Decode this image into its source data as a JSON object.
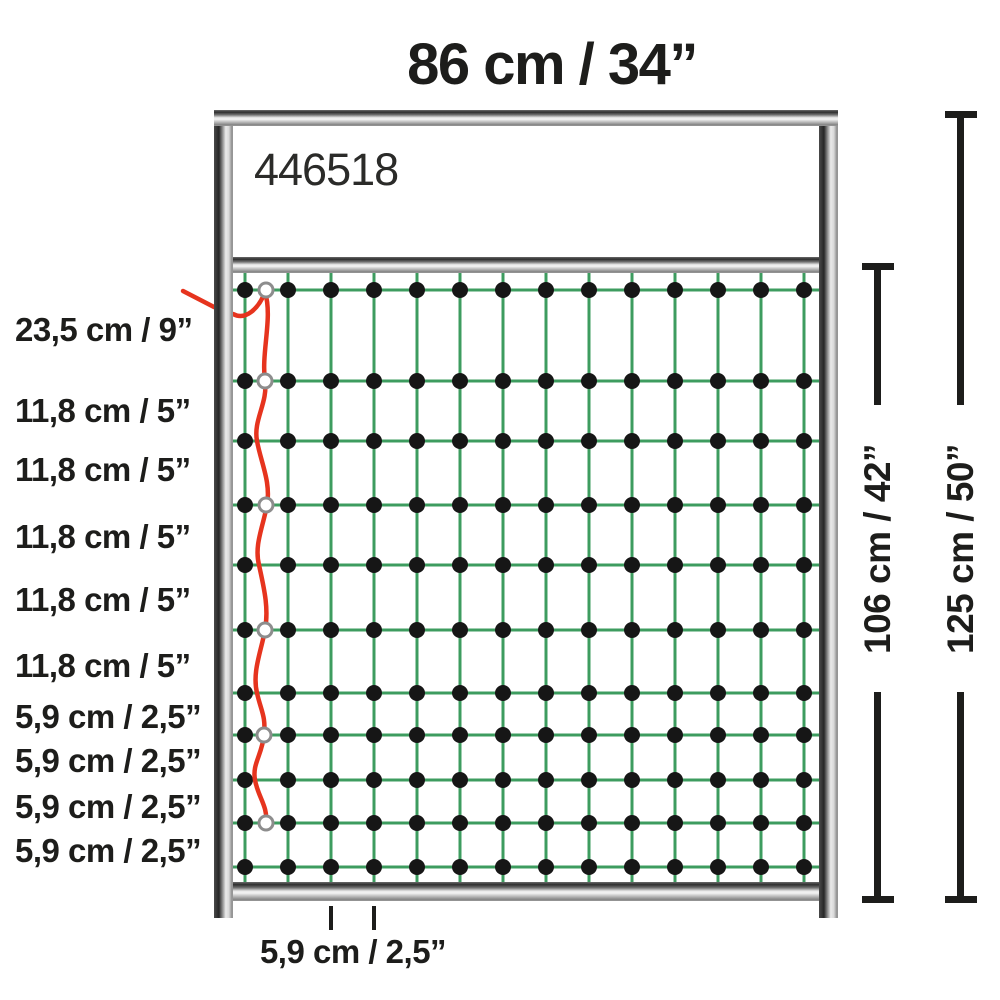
{
  "title": "86 cm / 34”",
  "product_number": "446518",
  "left_labels": [
    "23,5 cm / 9”",
    "11,8 cm / 5”",
    "11,8 cm / 5”",
    "11,8 cm / 5”",
    "11,8 cm / 5”",
    "11,8 cm / 5”",
    "5,9 cm / 2,5”",
    "5,9 cm / 2,5”",
    "5,9 cm / 2,5”",
    "5,9 cm / 2,5”"
  ],
  "right_dimensions": {
    "net_height": "106 cm / 42”",
    "total_height": "125 cm / 50”"
  },
  "bottom_label": "5,9 cm / 2,5”",
  "colors": {
    "net_green": "#3d9c5f",
    "conductor_red": "#e6341e",
    "knot_black": "#161616",
    "ring_stroke": "#8d8d8d",
    "text_black": "#1d1d1b"
  }
}
